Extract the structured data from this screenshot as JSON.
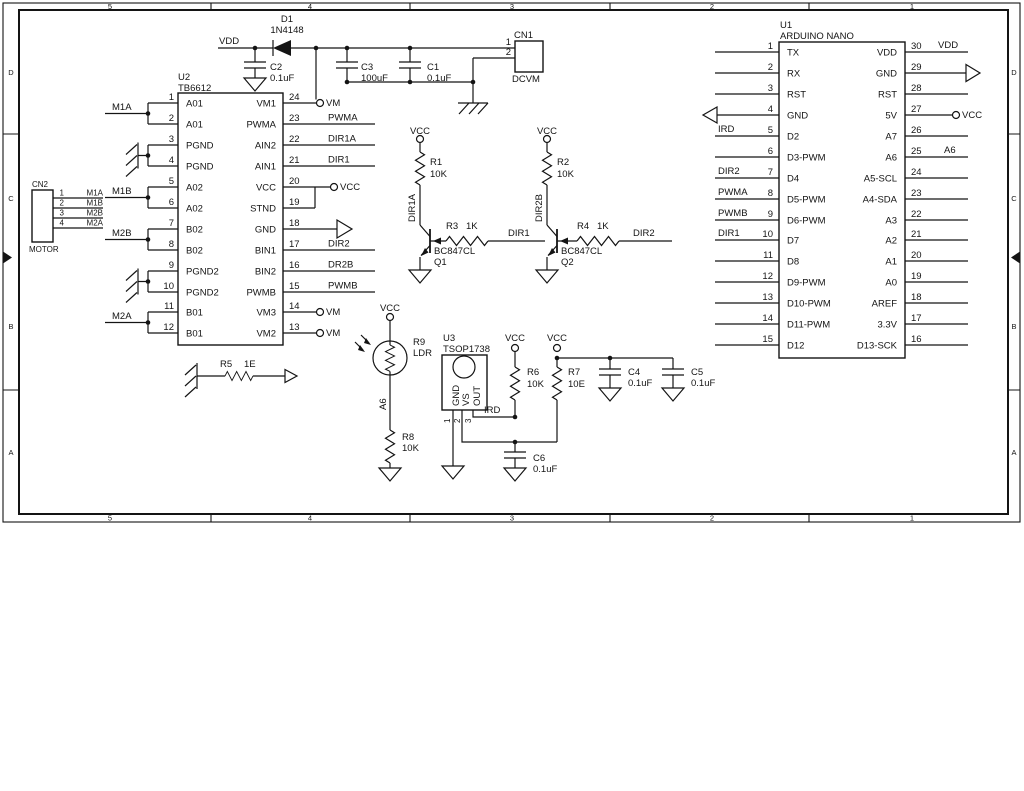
{
  "frame": {
    "cols": [
      "5",
      "4",
      "3",
      "2",
      "1"
    ],
    "rows": [
      "D",
      "C",
      "B",
      "A"
    ]
  },
  "power_symbols": {
    "vcc": "VCC",
    "vm": "VM",
    "vdd": "VDD"
  },
  "top_rail": {
    "vdd_label": "VDD",
    "d1_ref": "D1",
    "d1_value": "1N4148",
    "c2_ref": "C2",
    "c2_value": "0.1uF",
    "c3_ref": "C3",
    "c3_value": "100uF",
    "c1_ref": "C1",
    "c1_value": "0.1uF"
  },
  "cn1": {
    "ref": "CN1",
    "name": "DCVM",
    "pin1": "1",
    "pin2": "2"
  },
  "cn2": {
    "ref": "CN2",
    "name": "MOTOR",
    "pins": [
      {
        "num": "1",
        "net": "M1A"
      },
      {
        "num": "2",
        "net": "M1B"
      },
      {
        "num": "3",
        "net": "M2B"
      },
      {
        "num": "4",
        "net": "M2A"
      }
    ]
  },
  "u2": {
    "ref": "U2",
    "part": "TB6612",
    "left_pins": [
      {
        "num": "1",
        "name": "A01"
      },
      {
        "num": "2",
        "name": "A01"
      },
      {
        "num": "3",
        "name": "PGND"
      },
      {
        "num": "4",
        "name": "PGND"
      },
      {
        "num": "5",
        "name": "A02"
      },
      {
        "num": "6",
        "name": "A02"
      },
      {
        "num": "7",
        "name": "B02"
      },
      {
        "num": "8",
        "name": "B02"
      },
      {
        "num": "9",
        "name": "PGND2"
      },
      {
        "num": "10",
        "name": "PGND2"
      },
      {
        "num": "11",
        "name": "B01"
      },
      {
        "num": "12",
        "name": "B01"
      }
    ],
    "right_pins": [
      {
        "num": "24",
        "name": "VM1",
        "net": "VM"
      },
      {
        "num": "23",
        "name": "PWMA",
        "net": "PWMA"
      },
      {
        "num": "22",
        "name": "AIN2",
        "net": "DIR1A"
      },
      {
        "num": "21",
        "name": "AIN1",
        "net": "DIR1"
      },
      {
        "num": "20",
        "name": "VCC",
        "net": "VCC"
      },
      {
        "num": "19",
        "name": "STND",
        "net": ""
      },
      {
        "num": "18",
        "name": "GND",
        "net": ""
      },
      {
        "num": "17",
        "name": "BIN1",
        "net": "DIR2"
      },
      {
        "num": "16",
        "name": "BIN2",
        "net": "DR2B"
      },
      {
        "num": "15",
        "name": "PWMB",
        "net": "PWMB"
      },
      {
        "num": "14",
        "name": "VM3",
        "net": "VM"
      },
      {
        "num": "13",
        "name": "VM2",
        "net": "VM"
      }
    ],
    "pair_nets": [
      "M1A",
      "M1B",
      "M2B",
      "M2A"
    ]
  },
  "u1": {
    "ref": "U1",
    "part": "ARDUINO NANO",
    "left_pins": [
      {
        "num": "1",
        "name": "TX",
        "net": ""
      },
      {
        "num": "2",
        "name": "RX",
        "net": ""
      },
      {
        "num": "3",
        "name": "RST",
        "net": ""
      },
      {
        "num": "4",
        "name": "GND",
        "net": ""
      },
      {
        "num": "5",
        "name": "D2",
        "net": "IRD"
      },
      {
        "num": "6",
        "name": "D3-PWM",
        "net": ""
      },
      {
        "num": "7",
        "name": "D4",
        "net": "DIR2"
      },
      {
        "num": "8",
        "name": "D5-PWM",
        "net": "PWMA"
      },
      {
        "num": "9",
        "name": "D6-PWM",
        "net": "PWMB"
      },
      {
        "num": "10",
        "name": "D7",
        "net": "DIR1"
      },
      {
        "num": "11",
        "name": "D8",
        "net": ""
      },
      {
        "num": "12",
        "name": "D9-PWM",
        "net": ""
      },
      {
        "num": "13",
        "name": "D10-PWM",
        "net": ""
      },
      {
        "num": "14",
        "name": "D11-PWM",
        "net": ""
      },
      {
        "num": "15",
        "name": "D12",
        "net": ""
      }
    ],
    "right_pins": [
      {
        "num": "30",
        "name": "VDD",
        "net": "VDD"
      },
      {
        "num": "29",
        "name": "GND",
        "net": ""
      },
      {
        "num": "28",
        "name": "RST",
        "net": ""
      },
      {
        "num": "27",
        "name": "5V",
        "net": "VCC"
      },
      {
        "num": "26",
        "name": "A7",
        "net": ""
      },
      {
        "num": "25",
        "name": "A6",
        "net": "A6"
      },
      {
        "num": "24",
        "name": "A5-SCL",
        "net": ""
      },
      {
        "num": "23",
        "name": "A4-SDA",
        "net": ""
      },
      {
        "num": "22",
        "name": "A3",
        "net": ""
      },
      {
        "num": "21",
        "name": "A2",
        "net": ""
      },
      {
        "num": "20",
        "name": "A1",
        "net": ""
      },
      {
        "num": "19",
        "name": "A0",
        "net": ""
      },
      {
        "num": "18",
        "name": "AREF",
        "net": ""
      },
      {
        "num": "17",
        "name": "3.3V",
        "net": ""
      },
      {
        "num": "16",
        "name": "D13-SCK",
        "net": ""
      }
    ]
  },
  "q1": {
    "ref": "Q1",
    "part": "BC847CL",
    "collector_net": "DIR1A",
    "base_net": "DIR1",
    "pullup_ref": "R1",
    "pullup_value": "10K",
    "base_r_ref": "R3",
    "base_r_value": "1K"
  },
  "q2": {
    "ref": "Q2",
    "part": "BC847CL",
    "collector_net": "DIR2B",
    "base_net": "DIR2",
    "pullup_ref": "R2",
    "pullup_value": "10K",
    "base_r_ref": "R4",
    "base_r_value": "1K"
  },
  "r5": {
    "ref": "R5",
    "value": "1E"
  },
  "ldr": {
    "ref": "R9",
    "part": "LDR",
    "net": "A6",
    "r8_ref": "R8",
    "r8_value": "10K"
  },
  "u3": {
    "ref": "U3",
    "part": "TSOP1738",
    "out_net": "IRD",
    "pins": [
      {
        "num": "1",
        "name": "GND"
      },
      {
        "num": "2",
        "name": "VS"
      },
      {
        "num": "3",
        "name": "OUT"
      }
    ],
    "r6_ref": "R6",
    "r6_value": "10K",
    "r7_ref": "R7",
    "r7_value": "10E",
    "c6_ref": "C6",
    "c6_value": "0.1uF",
    "c4_ref": "C4",
    "c4_value": "0.1uF",
    "c5_ref": "C5",
    "c5_value": "0.1uF"
  }
}
